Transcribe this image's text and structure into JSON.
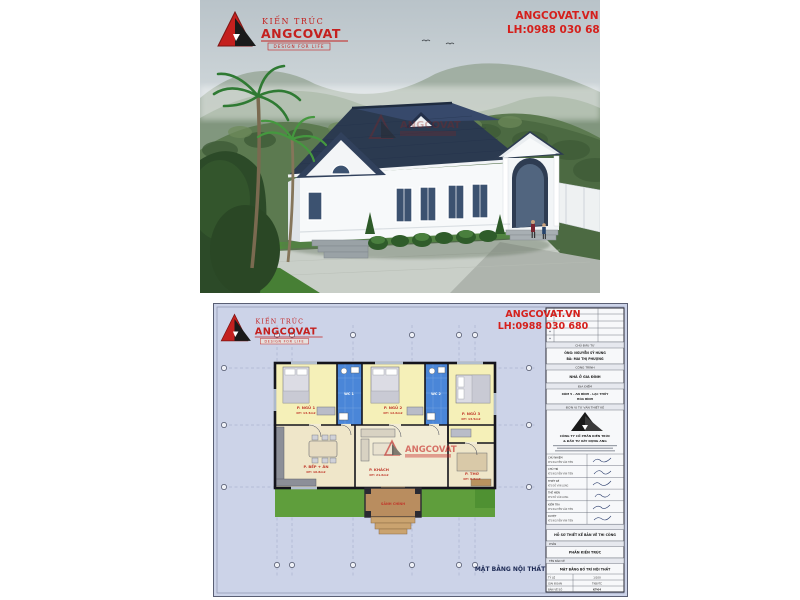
{
  "brand": {
    "line1": "KIẾN TRÚC",
    "line2": "ANGCOVAT",
    "tagline": "DESIGN FOR LIFE",
    "accent_red": "#c4201e",
    "accent_black": "#1a1a1a"
  },
  "contact": {
    "website": "ANGCOVAT.VN",
    "phone": "LH:0988 030 680",
    "color": "#d5201c"
  },
  "render": {
    "watermark": "ANGCOVAT",
    "roof_color": "#2b3a50",
    "wall_color": "#f7f9fa"
  },
  "plan": {
    "sheet_bg": "#ccd3e8",
    "drawing_label": "MẶT BẰNG NỘI THẤT",
    "watermark": "ANGCOVAT",
    "axis_markers": {
      "top": 6,
      "bottom": 6,
      "left": 3,
      "right": 3
    },
    "rooms": {
      "bedroom1": {
        "name": "P. NGỦ 1",
        "area": "DT: 13.3m2"
      },
      "wc1": {
        "name": "WC 1"
      },
      "bedroom2": {
        "name": "P. NGỦ 2",
        "area": "DT: 12.6m2"
      },
      "wc2": {
        "name": "WC 2"
      },
      "bedroom3": {
        "name": "P. NGỦ 3",
        "area": "DT: 13.5m2"
      },
      "kitchen": {
        "name": "P. BẾP + ĂN",
        "area": "DT: 16.8m2"
      },
      "living": {
        "name": "P. KHÁCH",
        "area": "DT: 21.6m2"
      },
      "worship": {
        "name": "P. THỜ",
        "area": "DT: 9.6m2"
      },
      "porch": {
        "name": "SẢNH CHÍNH"
      }
    }
  },
  "title_block": {
    "investor_label": "CHỦ ĐẦU TƯ",
    "investor_1": "ÔNG: NGUYỄN SỸ HÙNG",
    "investor_2": "BÀ: MAI THỊ PHƯỢNG",
    "project_label": "CÔNG TRÌNH",
    "project": "NHÀ Ở GIA ĐÌNH",
    "location_label": "ĐỊA ĐIỂM",
    "location_1": "XÓM 5 - AN BÌNH - LẠC THỦY",
    "location_2": "HÒA BÌNH",
    "consultant_label": "ĐƠN VỊ TƯ VẤN THIẾT KẾ",
    "company_1": "CÔNG TY CỔ PHẦN KIẾN TRÚC",
    "company_2": "& ĐẦU TƯ XÂY DỰNG ANG",
    "signature_rows": [
      {
        "label": "CHỦ NHIỆM",
        "name": "KTS NGUYỄN VĂN TIÊN"
      },
      {
        "label": "CHỦ TRÌ",
        "name": "KTS NGUYỄN VĂN TIÊN"
      },
      {
        "label": "THIẾT KẾ",
        "name": "KTS ĐỖ VĂN LONG"
      },
      {
        "label": "THỂ HIỆN",
        "name": "KTS ĐỖ VĂN LONG"
      },
      {
        "label": "KIỂM TRA",
        "name": "KTS NGUYỄN VĂN TIÊN"
      },
      {
        "label": "DUYỆT",
        "name": "KTS NGUYỄN VĂN TIÊN"
      }
    ],
    "dossier": "HỒ SƠ THIẾT KẾ BẢN VẼ THI CÔNG",
    "part_header": "PHẦN",
    "part": "PHẦN KIẾN TRÚC",
    "drawing_header": "TÊN BẢN VẼ",
    "drawing_name": "MẶT BẰNG BỐ TRÍ NỘI THẤT",
    "scale_label": "TỶ LỆ",
    "scale_value": "1/100",
    "stage_label": "GIAI ĐOẠN",
    "stage_value": "TKBVTC",
    "sheet_label": "BẢN VẼ SỐ",
    "sheet_value": "KT-04"
  }
}
